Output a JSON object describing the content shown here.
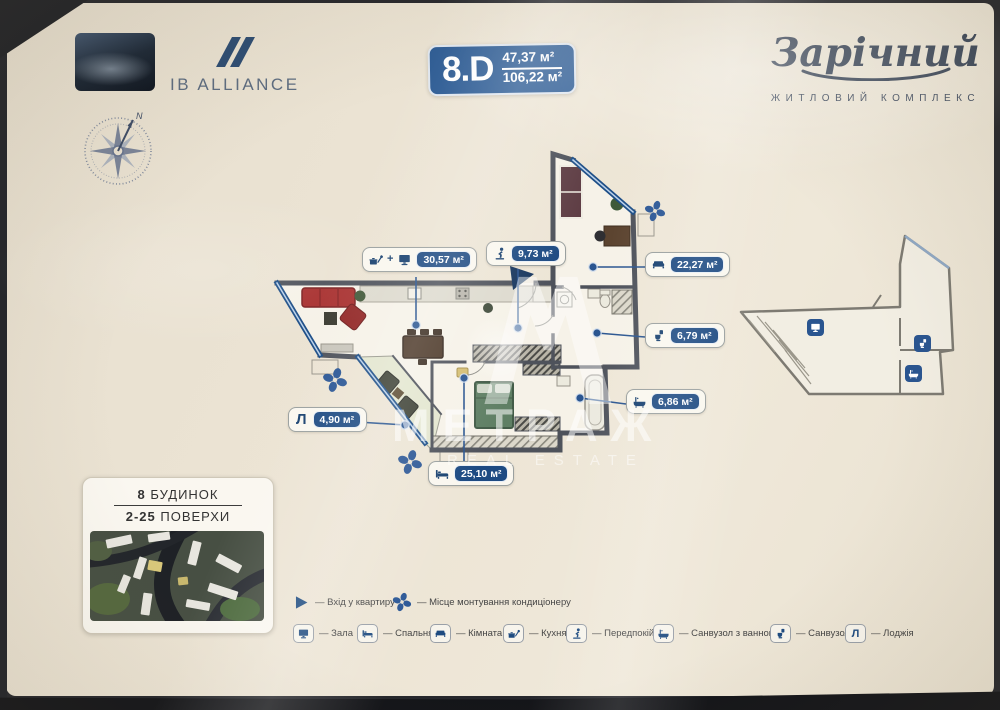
{
  "header": {
    "developer": {
      "name": "IB ALLIANCE"
    },
    "unit": {
      "code": "8.D",
      "living_area": "47,37 м²",
      "total_area": "106,22 м²"
    },
    "complex": {
      "name": "Зарічний",
      "subtitle": "ЖИТЛОВИЙ КОМПЛЕКС"
    },
    "compass": {
      "north": "N"
    }
  },
  "plan": {
    "labels": {
      "living": {
        "plus": "+",
        "value": "30,57 м²"
      },
      "hall": {
        "value": "9,73 м²"
      },
      "room": {
        "value": "22,27 м²"
      },
      "wc": {
        "value": "6,79 м²"
      },
      "bath": {
        "value": "6,86 м²"
      },
      "bedroom": {
        "value": "25,10 м²"
      },
      "loggia": {
        "letter": "Л",
        "value": "4,90 м²"
      }
    }
  },
  "building_card": {
    "building_number": "8",
    "building_word": "БУДИНОК",
    "floors_range": "2-25",
    "floors_word": "ПОВЕРХИ"
  },
  "legend": {
    "dash": "—",
    "entry_label": "Вхід у квартиру",
    "ac_label": "Місце монтування кондиціонеру",
    "items": [
      {
        "icon": "tv-icon",
        "label": "Зала"
      },
      {
        "icon": "bed-icon",
        "label": "Спальня"
      },
      {
        "icon": "sofa-icon",
        "label": "Кімната"
      },
      {
        "icon": "kitchen-icon",
        "label": "Кухня"
      },
      {
        "icon": "person-icon",
        "label": "Передпокій"
      },
      {
        "icon": "bathtub-icon",
        "label": "Санвузол з ванною"
      },
      {
        "icon": "toilet-icon",
        "label": "Санвузол"
      },
      {
        "icon": "letter-l-icon",
        "label": "Лоджія"
      }
    ]
  },
  "watermark": {
    "brand": "МЕТРАЖ",
    "tagline": "REAL ESTATE"
  },
  "colors": {
    "navy": "#2b5a93",
    "wall": "#4e525b",
    "sofa_red": "#a8302f",
    "bed_green": "#5f7f64"
  }
}
